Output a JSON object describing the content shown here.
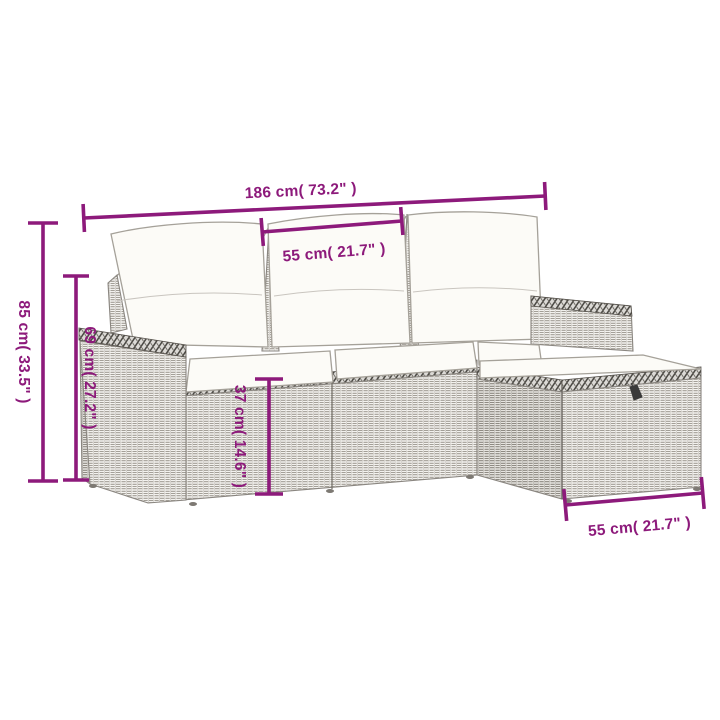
{
  "diagram": {
    "type": "product-dimension-diagram",
    "subject": "Gray poly rattan garden sofa set with cream cushions: 3-seater sofa with two armrests and an ottoman",
    "background": "#ffffff",
    "accent_color": "#8D1A7B",
    "dimensions": {
      "overall_width": {
        "label": "186 cm( 73.2\" )",
        "cm": 186,
        "inches": 73.2
      },
      "seat_width": {
        "label": "55 cm( 21.7\" )",
        "cm": 55,
        "inches": 21.7
      },
      "overall_height": {
        "label": "85 cm( 33.5\" )",
        "cm": 85,
        "inches": 33.5
      },
      "back_height": {
        "label": "69 cm( 27.2\" )",
        "cm": 69,
        "inches": 27.2
      },
      "seat_height": {
        "label": "37 cm( 14.6\" )",
        "cm": 37,
        "inches": 14.6
      },
      "ottoman_width": {
        "label": "55 cm( 21.7\" )",
        "cm": 55,
        "inches": 21.7
      }
    }
  }
}
